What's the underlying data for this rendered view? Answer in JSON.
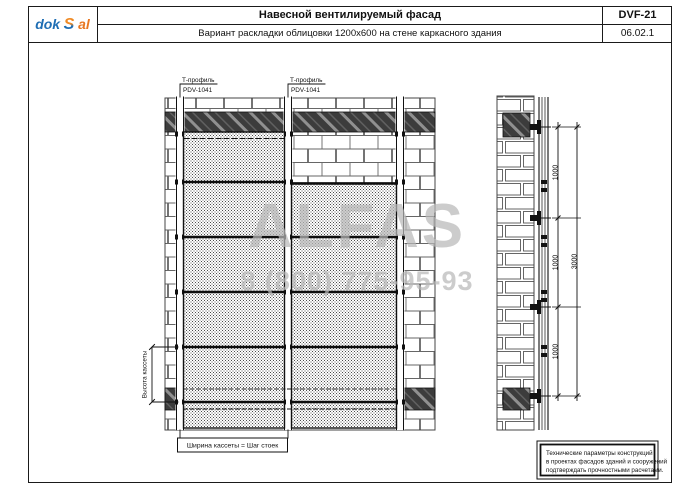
{
  "header": {
    "logo": {
      "part1": "dok",
      "part2": "S",
      "part3": "al"
    },
    "title": "Навесной вентилируемый фасад",
    "subtitle": "Вариант раскладки облицовки 1200x600 на стене каркасного здания",
    "code": "DVF-21",
    "sheet_no": "06.02.1"
  },
  "drawing": {
    "callouts": [
      {
        "line1": "Т-профиль",
        "line2": "PDV-1041"
      },
      {
        "line1": "Т-профиль",
        "line2": "PDV-1041"
      }
    ],
    "dim_height_label": "Высота кассеты",
    "dim_width_label": "Ширина кассеты = Шаг стоек",
    "side_dims": {
      "segments": [
        "1000",
        "1000",
        "1000"
      ],
      "total": "3000"
    },
    "note": [
      "Технические параметры конструкций",
      "в проектах фасадов зданий и сооружений",
      "подтверждать прочностными расчетами."
    ]
  },
  "watermark": {
    "name": "ALFAS",
    "phone": "8 (800) 775-95-93"
  },
  "colors": {
    "line": "#1a1a1a",
    "logo_blue": "#1f6eb4",
    "logo_orange": "#e87722",
    "watermark_gray": "#b8b8b8"
  }
}
